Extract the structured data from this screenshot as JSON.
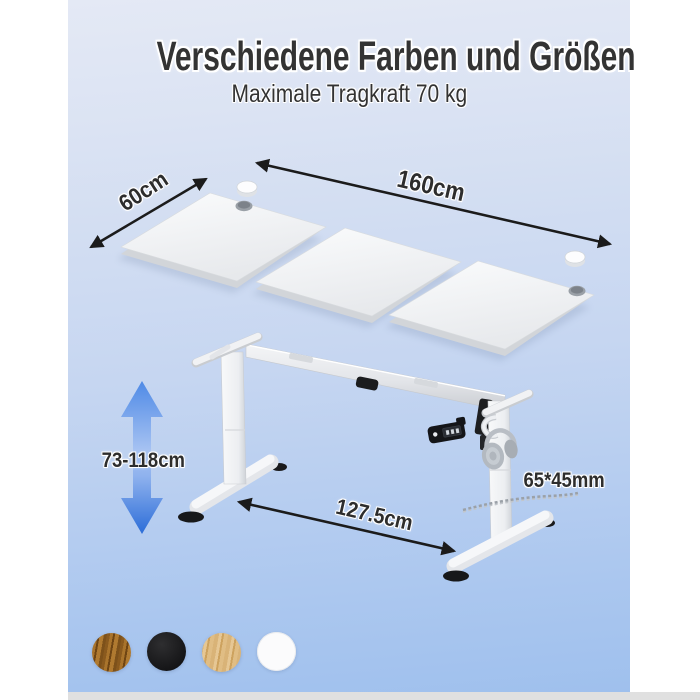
{
  "image": {
    "title": "Verschiedene Farben und Größen",
    "subtitle": "Maximale Tragkraft 70 kg"
  },
  "annotations": {
    "top_depth": "60cm",
    "top_width": "160cm",
    "height_range": "73-118cm",
    "foot_span": "127.5cm",
    "column_profile": "65*45mm"
  },
  "color_swatches": [
    {
      "name": "dark wood",
      "hex": "#96621f"
    },
    {
      "name": "black",
      "hex": "#1b1b1d"
    },
    {
      "name": "light oak",
      "hex": "#ddb87e"
    },
    {
      "name": "white",
      "hex": "#fbfbfc"
    }
  ],
  "palette": {
    "background_top": "#e4e9f5",
    "background_bottom": "#9fc0ed",
    "height_arrow_blue": "#2f6fd9",
    "dimension_arrow_black": "#1b1b1b",
    "text_color": "#2d2d2d",
    "side_margin_white": "#ffffff",
    "bottom_strip_gray": "#e0e0e0"
  }
}
